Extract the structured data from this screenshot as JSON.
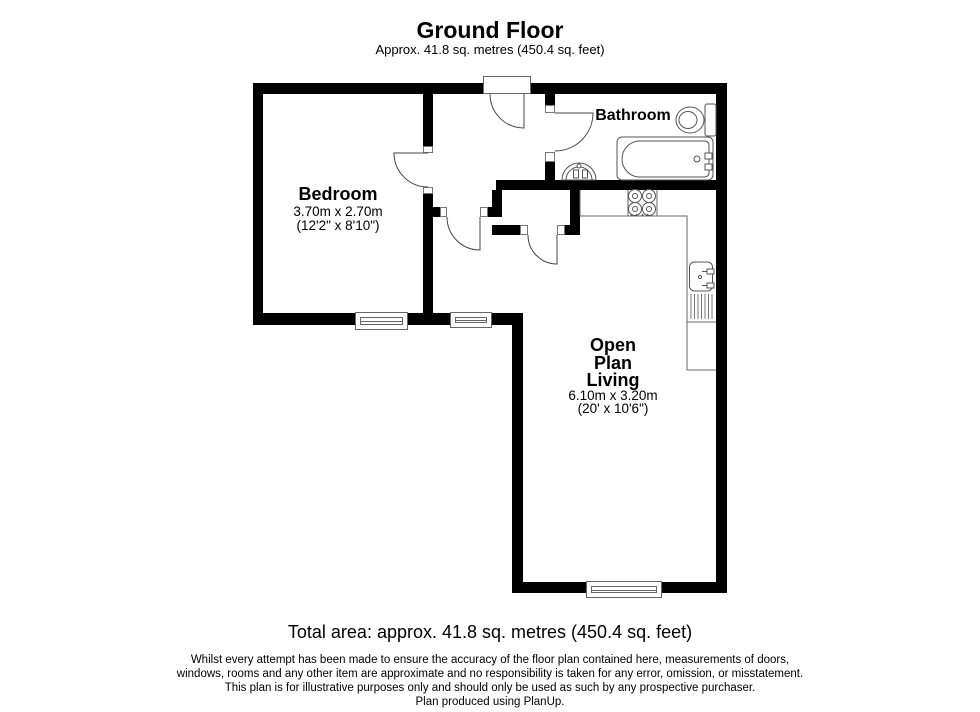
{
  "header": {
    "title": "Ground Floor",
    "subtitle": "Approx. 41.8 sq. metres (450.4 sq. feet)"
  },
  "rooms": {
    "bedroom": {
      "name": "Bedroom",
      "dims_metric": "3.70m x 2.70m",
      "dims_imperial": "(12'2\" x 8'10\")"
    },
    "bathroom": {
      "name": "Bathroom"
    },
    "living": {
      "name_lines": [
        "Open",
        "Plan",
        "Living"
      ],
      "dims_metric": "6.10m x 3.20m",
      "dims_imperial": "(20' x 10'6\")"
    }
  },
  "footer": {
    "total_area": "Total area: approx. 41.8 sq. metres (450.4 sq. feet)",
    "disclaimer": [
      "Whilst every attempt has been made to ensure the accuracy of the floor plan contained here, measurements of doors,",
      "windows, rooms and any other item are approximate and no responsibility is taken for any error, omission, or misstatement.",
      "This plan is for illustrative purposes only and should only be used as such by any prospective purchaser.",
      "Plan produced using PlanUp."
    ]
  },
  "colors": {
    "wall": "#000000",
    "fixture_line": "#555555",
    "text": "#000000"
  }
}
